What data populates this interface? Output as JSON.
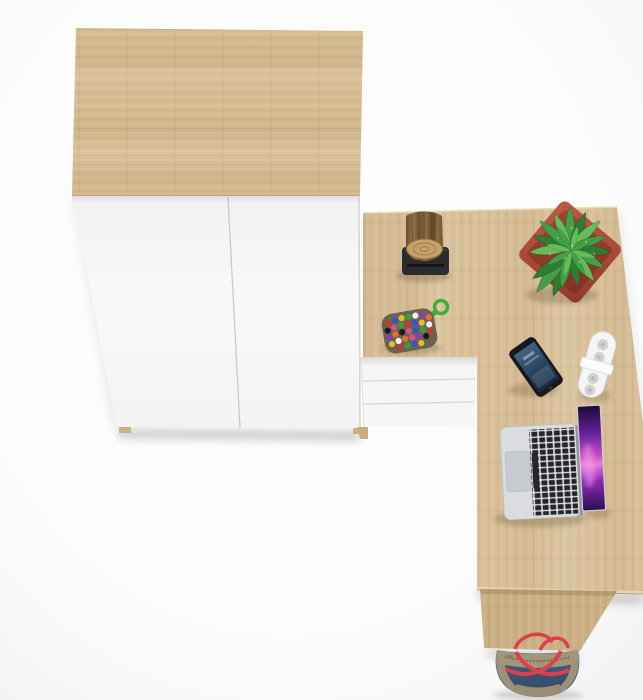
{
  "meta": {
    "title": "L-shaped corner desk and wardrobe in oak and white — top view product render",
    "view": "top-down",
    "background": "white studio"
  },
  "furniture": {
    "wardrobe": {
      "label": "Two-door wardrobe, oak top with white doors and two feet",
      "doors": 2
    },
    "desk": {
      "label": "L-shaped corner desk in oak finish with built-in white drawer unit",
      "drawers": 3
    },
    "leg_panel": {
      "label": "Oak side panel leg of the desk"
    }
  },
  "props": {
    "log_vase": {
      "label": "Rustic wooden log vase on black stand"
    },
    "plant": {
      "label": "Green leafy plant in square terracotta pot"
    },
    "keychain": {
      "label": "Multicolor bead pouch keychain with green paracord knot"
    },
    "phone": {
      "label": "Black smartphone with dark blue screen"
    },
    "power_strip": {
      "label": "White capsule power strip with round sockets"
    },
    "laptop": {
      "label": "Open silver laptop with black keys and purple wallpaper"
    },
    "bag": {
      "label": "Blue and khaki tote bag with red straps below the desk"
    }
  },
  "colors": {
    "background": "#ffffff",
    "background_edge": "#f3f3f4",
    "oak": "#d6bd92",
    "oak_light": "#e6d3ac",
    "oak_dark": "#c2a878",
    "oak_desk": "#d9c199",
    "oak_leg": "#cbb083",
    "white_front": "#f6f6f7",
    "drawer_gap": "#d8d8da",
    "stand_black": "#2b2c30",
    "log_side": "#8a6a42",
    "log_face": "#c7a06a",
    "pot": "#b4513d",
    "pot_dark": "#8f3a2a",
    "leaf_dark": "#2e7d32",
    "leaf_mid": "#43a047",
    "leaf_light": "#66bb5a",
    "cord_green": "#3fae35",
    "pouch": "#6b6250",
    "bead0": "#cf3535",
    "bead1": "#2f57c9",
    "bead2": "#e3bd2c",
    "bead3": "#34a13e",
    "bead4": "#f2f2f2",
    "bead5": "#8a3fb0",
    "bead6": "#e2702a",
    "bead7": "#1c1c1c",
    "bead8": "#d44f9e",
    "phone_body": "#17191d",
    "phone_screen": "#2c4a66",
    "strip_white": "#f5f5f5",
    "socket": "#d2d2d2",
    "laptop_silver": "#dadcdf",
    "key_black": "#26272b",
    "trackpad": "#c7cace",
    "screen_pink": "#e14fd0",
    "screen_purple": "#8d2bb4",
    "screen_dark": "#220c44",
    "denim": "#3c566f",
    "khaki": "#a3957a",
    "strap_red": "#dd3f4c"
  }
}
